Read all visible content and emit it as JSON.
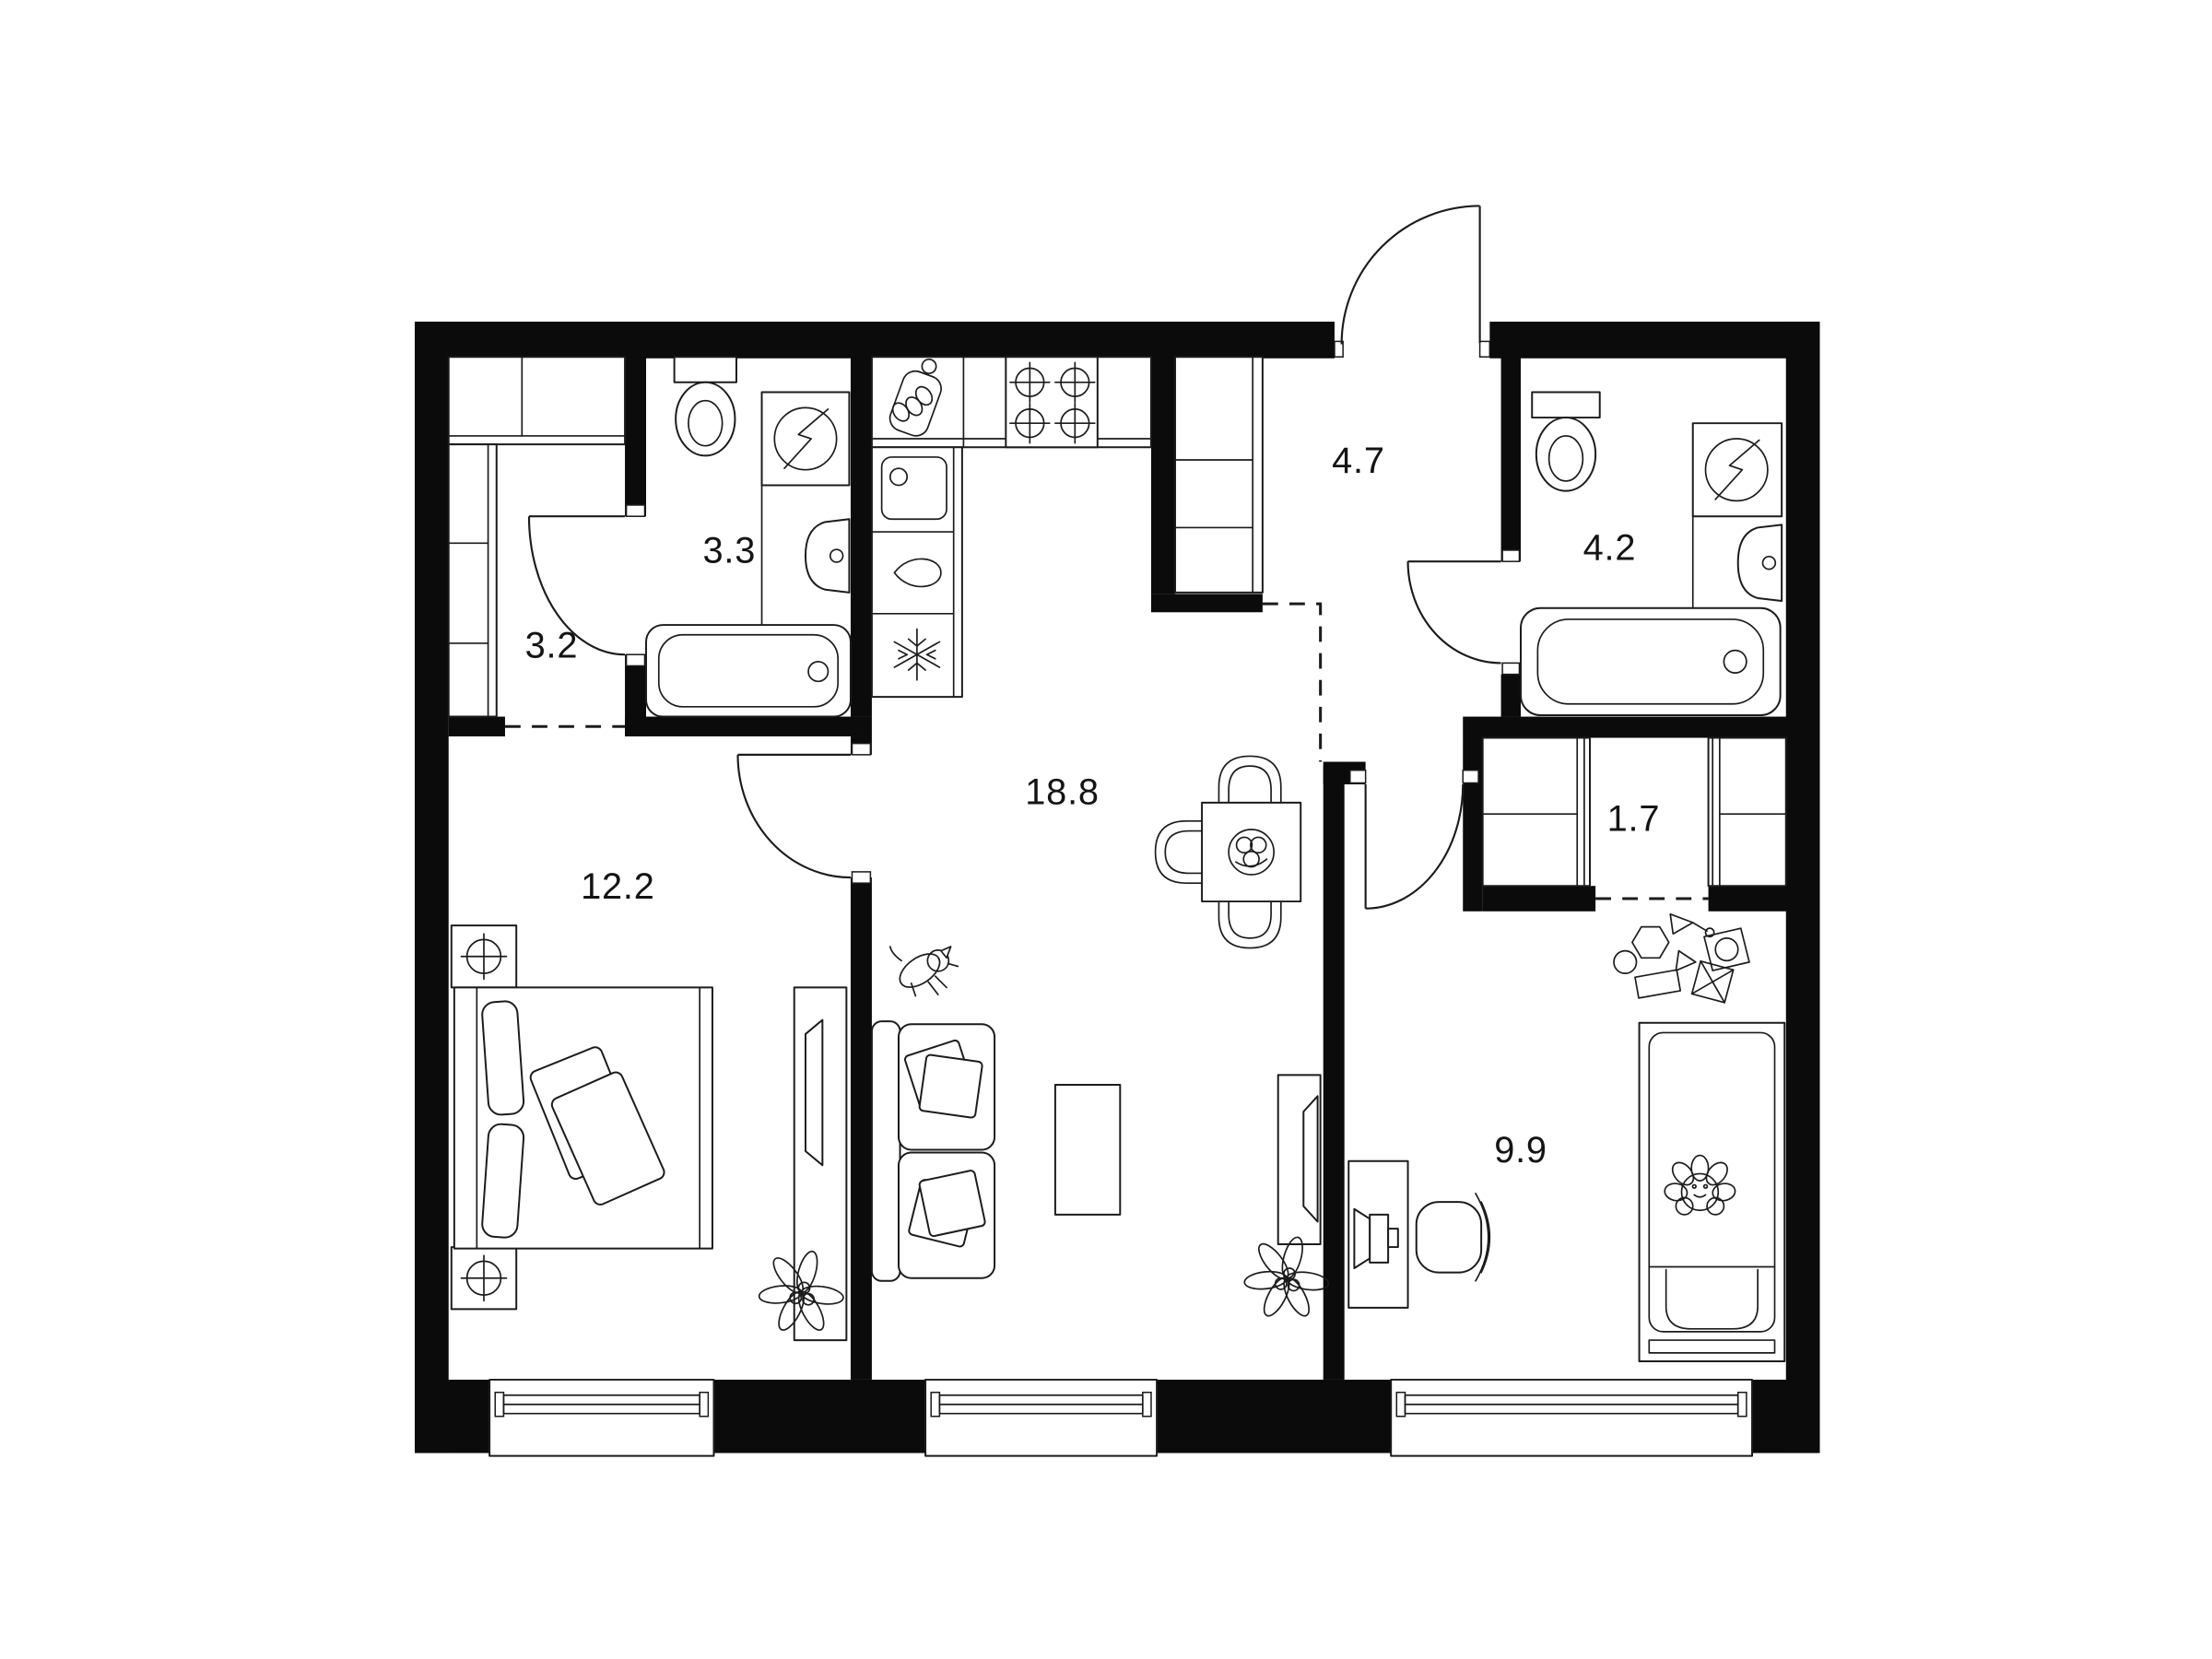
{
  "page": {
    "title": "Apartment floor plan",
    "background": "#ffffff"
  },
  "plan": {
    "wall_color": "#0b0b0b",
    "line_color": "#1c1c1c",
    "rooms": [
      {
        "key": "hallway-small",
        "label": "3.2"
      },
      {
        "key": "bathroom-small",
        "label": "3.3"
      },
      {
        "key": "entrance-hall",
        "label": "4.7"
      },
      {
        "key": "bathroom",
        "label": "4.2"
      },
      {
        "key": "kitchen-living",
        "label": "18.8"
      },
      {
        "key": "bedroom",
        "label": "12.2"
      },
      {
        "key": "storage",
        "label": "1.7"
      },
      {
        "key": "child-room",
        "label": "9.9"
      }
    ],
    "fixtures": [
      "toilet-icon",
      "washing-machine-icon",
      "bathtub-icon",
      "wall-sink-icon",
      "cutting-board-icon",
      "stove-icon",
      "kitchen-sink-icon",
      "dishwasher-icon",
      "fridge-icon",
      "wardrobe-icon",
      "dining-table-icon",
      "chair-icon",
      "fruit-bowl-icon",
      "sofa-icon",
      "coffee-table-icon",
      "tv-icon",
      "dog-icon",
      "plant-icon",
      "double-bed-icon",
      "nightstand-lamp-icon",
      "desk-icon",
      "monitor-icon",
      "office-chair-icon",
      "child-bed-icon",
      "teddy-toy-icon",
      "toy-blocks-icon",
      "window-icon",
      "door-swing-icon"
    ]
  }
}
